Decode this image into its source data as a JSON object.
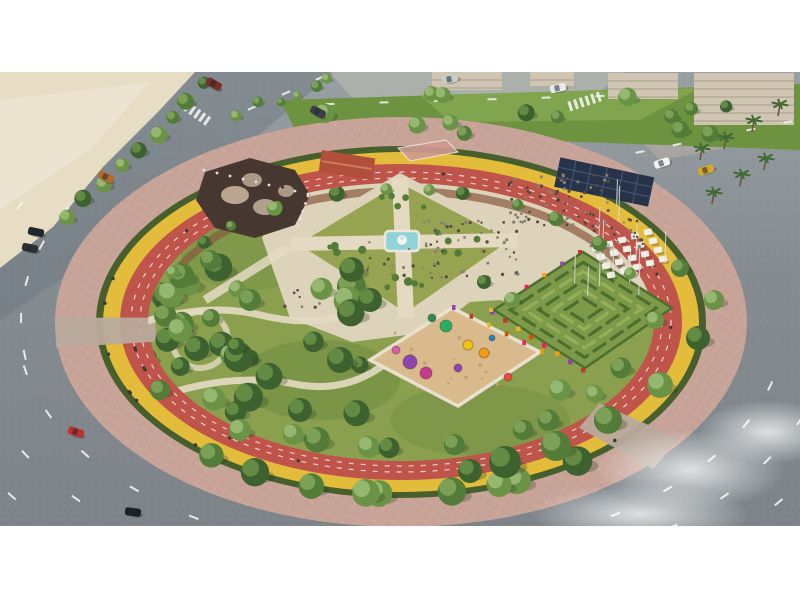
{
  "colors": {
    "letterbox": "#ffffff",
    "road_light": "#9aa1a5",
    "road_dark": "#7d8489",
    "road_avenue": "#6e7780",
    "sidewalk": "#b2b5ae",
    "sidewalk_warm": "#b3a9a2",
    "sand": "#e7ddc5",
    "sand_streak": "#f0e9d7",
    "green_strip": "#6d9340",
    "green_strip_light": "#8aad55",
    "building": "#cfc5b2",
    "building_dark": "#b0a593",
    "paved_ring": "#c7a297",
    "paved_grid": "#e9dfd7",
    "hedge": "#465f2c",
    "cycle_lane": "#e2bc3a",
    "track": "#bf544a",
    "track_line": "#ffffff",
    "park_grass": "#8aa04f",
    "grass_dark": "#6c8a3e",
    "grass_light": "#a3b566",
    "plaza": "#ddd3bb",
    "path": "#e4dac2",
    "lawn": "#96a452",
    "water": "#8fd2d8",
    "fountain": "#f6f3ea",
    "mulch": "#8a5a40",
    "maze_base": "#7d9a4a",
    "maze_hedge": "#4d6f2e",
    "maze_hedge_light": "#93b058",
    "play_sand": "#d9ba8c",
    "play_wall": "#e9e1ce",
    "canopy": "#273349",
    "canopy_grid": "#48597a",
    "umbrella": "#f2efe6",
    "structure": "#463830",
    "stone": "#c6b29b",
    "column": "#e8e3d8",
    "roof_red": "#b14f3a",
    "court": "#cf9a92",
    "pole": "#d9dcd6",
    "tree_trunk": "#6b543e",
    "people_dark": "#564c42",
    "people_light": "#8a7f70",
    "rider": "#3d3930",
    "dash": "#f5f6f2",
    "crosswalk": "#f2f2ee",
    "entrance": "#b9aa9d"
  },
  "scene": {
    "center": {
      "x": 401,
      "y": 322
    },
    "rings": {
      "pink": [
        346,
        205
      ],
      "hedge": [
        305,
        176
      ],
      "yellow": [
        298,
        170
      ],
      "red": [
        281,
        158
      ],
      "inner": [
        253,
        139
      ],
      "lane1": [
        270,
        150
      ],
      "lane2": [
        261,
        144
      ],
      "mulch": [
        244,
        131
      ]
    },
    "tree_palette": [
      "#3e6130",
      "#527c38",
      "#6b9346",
      "#84a85c",
      "#9dbd78"
    ],
    "flower_colors": [
      "#8e44ad",
      "#c0392b",
      "#e6b820",
      "#d35400",
      "#e91e63",
      "#f39c12"
    ],
    "garden": {
      "T": [
        400,
        178
      ],
      "R": [
        518,
        240
      ],
      "B": [
        406,
        318
      ],
      "L": [
        290,
        244
      ],
      "C": [
        403,
        242
      ]
    },
    "maze": {
      "T": [
        583,
        252
      ],
      "R": [
        672,
        308
      ],
      "B": [
        585,
        368
      ],
      "L": [
        494,
        310
      ]
    },
    "playground": {
      "T": [
        452,
        308
      ],
      "R": [
        540,
        352
      ],
      "B": [
        458,
        406
      ],
      "L": [
        370,
        360
      ]
    },
    "equipment": [
      [
        410,
        362,
        7,
        "#8e44ad"
      ],
      [
        426,
        373,
        6,
        "#c23b8f"
      ],
      [
        446,
        326,
        6,
        "#27ae60"
      ],
      [
        432,
        318,
        4,
        "#2e8b57"
      ],
      [
        468,
        345,
        5,
        "#f1c40f"
      ],
      [
        484,
        353,
        5,
        "#f39c12"
      ],
      [
        508,
        377,
        4,
        "#e74c3c"
      ],
      [
        396,
        350,
        4,
        "#d35fae"
      ],
      [
        458,
        368,
        4,
        "#8e44ad"
      ],
      [
        492,
        338,
        3,
        "#2980b9"
      ]
    ],
    "crowds": [
      [
        560,
        200,
        80,
        52,
        26
      ],
      [
        470,
        250,
        55,
        48,
        30
      ],
      [
        402,
        258,
        22,
        40,
        20
      ],
      [
        298,
        296,
        10,
        25,
        12
      ],
      [
        618,
        234,
        22,
        30,
        16
      ]
    ],
    "dash_arcs": [
      [
        384,
        232,
        100,
        168,
        7
      ],
      [
        432,
        268,
        104,
        162,
        6
      ],
      [
        478,
        300,
        110,
        156,
        5
      ],
      [
        384,
        232,
        16,
        76,
        7
      ],
      [
        430,
        264,
        22,
        70,
        6
      ],
      [
        476,
        296,
        28,
        66,
        5
      ],
      [
        380,
        236,
        172,
        208,
        5
      ],
      [
        424,
        266,
        176,
        206,
        4
      ]
    ],
    "dash_rows": [
      [
        330,
        104,
        600,
        96,
        6
      ],
      [
        640,
        152,
        788,
        122,
        5
      ],
      [
        252,
        108,
        320,
        78,
        3
      ]
    ],
    "crosswalks": [
      [
        586,
        101,
        -18
      ],
      [
        196,
        113,
        35
      ]
    ],
    "cars": [
      [
        662,
        163,
        -18,
        "#f2f2ef"
      ],
      [
        706,
        170,
        -18,
        "#d4a72c"
      ],
      [
        318,
        112,
        28,
        "#3a3f45"
      ],
      [
        214,
        84,
        30,
        "#7b2d28"
      ],
      [
        450,
        79,
        -12,
        "#c8ccc9"
      ],
      [
        558,
        88,
        -12,
        "#e9e9e6"
      ],
      [
        36,
        232,
        12,
        "#23262a"
      ],
      [
        30,
        248,
        12,
        "#2c3034"
      ],
      [
        76,
        432,
        18,
        "#c03028"
      ],
      [
        133,
        512,
        8,
        "#1d2024"
      ],
      [
        106,
        177,
        25,
        "#b56a28"
      ]
    ],
    "palms": [
      [
        700,
        160
      ],
      [
        724,
        149
      ],
      [
        752,
        132
      ],
      [
        778,
        116
      ],
      [
        740,
        186
      ],
      [
        712,
        204
      ],
      [
        764,
        170
      ]
    ],
    "tree_clusters": [
      {
        "x0": 145,
        "y0": 235,
        "x1": 360,
        "y1": 425,
        "n": 26,
        "rmin": 8,
        "rmax": 15,
        "clip": true
      },
      {
        "x0": 300,
        "y0": 92,
        "x1": 795,
        "y1": 136,
        "n": 14,
        "rmin": 6,
        "rmax": 10,
        "clip": false
      }
    ],
    "tree_rings": [
      {
        "rx": 236,
        "ry": 126,
        "a0": 95,
        "a1": 205,
        "n": 10,
        "rmin": 9,
        "rmax": 13,
        "clip": true
      },
      {
        "rx": 236,
        "ry": 126,
        "a0": 20,
        "a1": 90,
        "n": 6,
        "rmin": 8,
        "rmax": 11,
        "clip": true
      },
      {
        "rx": 246,
        "ry": 133,
        "a0": 205,
        "a1": 335,
        "n": 12,
        "rmin": 5,
        "rmax": 8,
        "clip": true
      },
      {
        "rx": 300,
        "ry": 172,
        "a0": 55,
        "a1": 128,
        "n": 9,
        "rmin": 11,
        "rmax": 15,
        "clip": false
      }
    ],
    "tree_lines": [
      {
        "x0": 205,
        "y0": 85,
        "x1": 70,
        "y1": 215,
        "n": 9,
        "rmin": 6,
        "rmax": 9
      },
      {
        "x0": 240,
        "y0": 112,
        "x1": 330,
        "y1": 80,
        "n": 6,
        "rmin": 4,
        "rmax": 6
      }
    ],
    "big_trees": [
      [
        505,
        462,
        16
      ],
      [
        556,
        446,
        15
      ],
      [
        608,
        420,
        14
      ],
      [
        660,
        385,
        13
      ],
      [
        470,
        471,
        12
      ],
      [
        698,
        338,
        12
      ],
      [
        714,
        300,
        10
      ],
      [
        680,
        268,
        9
      ],
      [
        655,
        320,
        9
      ],
      [
        560,
        390,
        11
      ],
      [
        512,
        300,
        8
      ],
      [
        484,
        282,
        7
      ],
      [
        370,
        300,
        12
      ],
      [
        340,
        360,
        13
      ],
      [
        300,
        410,
        12
      ],
      [
        240,
        430,
        11
      ],
      [
        180,
        330,
        12
      ],
      [
        210,
        260,
        10
      ],
      [
        250,
        300,
        11
      ],
      [
        160,
        390,
        10
      ]
    ],
    "runners": {
      "rx": 270,
      "ry": 150,
      "n": 16
    },
    "cyclists": {
      "rx": 298,
      "ry": 170,
      "n": 12
    },
    "entrances": [
      {
        "a": 177,
        "w": 15
      },
      {
        "a": 40,
        "w": 20
      }
    ],
    "poles": {
      "x0": 548,
      "x1": 668,
      "y0": 200,
      "y1": 305,
      "n": 13,
      "h": 34
    },
    "umbrellas": {
      "x": 596,
      "y": 248,
      "cols": 5,
      "rows": 4,
      "ux": 13,
      "uy": -4,
      "vx": 5,
      "vy": 9
    },
    "fog": [
      [
        690,
        470,
        95,
        40
      ],
      [
        768,
        432,
        70,
        32
      ],
      [
        640,
        514,
        110,
        30
      ]
    ],
    "buildings": [
      [
        694,
        73,
        100,
        52
      ],
      [
        608,
        73,
        70,
        26
      ],
      [
        432,
        72,
        70,
        18
      ],
      [
        530,
        72,
        44,
        14
      ]
    ],
    "band": {
      "top": 72,
      "bottom": 526
    }
  }
}
